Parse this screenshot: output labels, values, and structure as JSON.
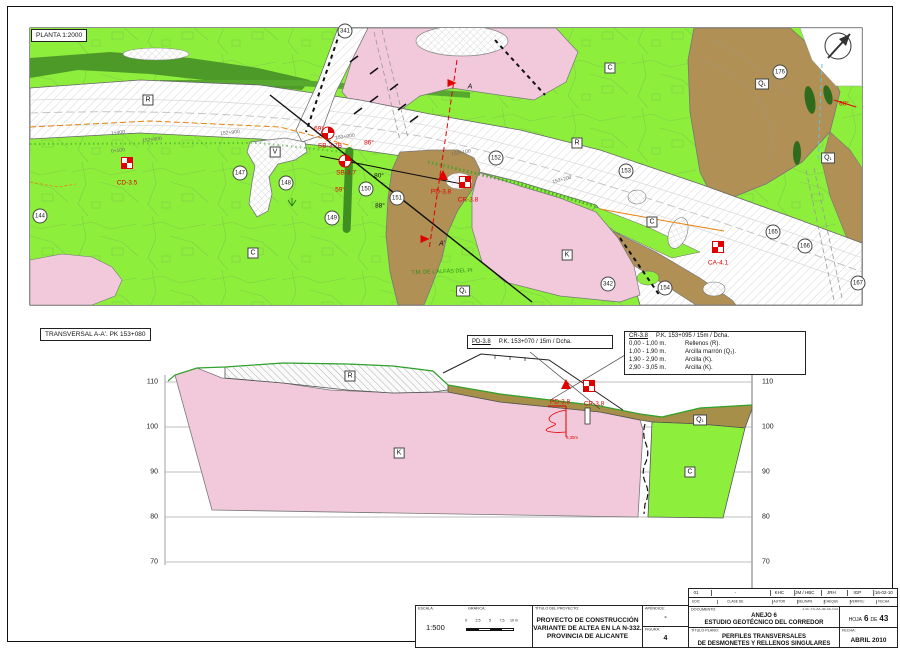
{
  "sheet": {
    "plan_title": "PLANTA 1:2000",
    "section_title": "TRANSVERSAL A-A'. PK 153+080"
  },
  "plan": {
    "unit_labels": [
      {
        "t": "R",
        "x": 148,
        "y": 100
      },
      {
        "t": "R",
        "x": 577,
        "y": 143
      },
      {
        "t": "V",
        "x": 275,
        "y": 152
      },
      {
        "t": "C",
        "x": 253,
        "y": 253
      },
      {
        "t": "C",
        "x": 610,
        "y": 68
      },
      {
        "t": "C",
        "x": 652,
        "y": 222
      },
      {
        "t": "K",
        "x": 567,
        "y": 255
      },
      {
        "t": "Q₁",
        "x": 762,
        "y": 84
      },
      {
        "t": "Q₁",
        "x": 828,
        "y": 158
      },
      {
        "t": "Q₁",
        "x": 463,
        "y": 291
      }
    ],
    "point_circles": [
      {
        "n": "144",
        "x": 40,
        "y": 216
      },
      {
        "n": "147",
        "x": 240,
        "y": 173
      },
      {
        "n": "148",
        "x": 286,
        "y": 183
      },
      {
        "n": "149",
        "x": 332,
        "y": 218
      },
      {
        "n": "150",
        "x": 366,
        "y": 189
      },
      {
        "n": "151",
        "x": 397,
        "y": 198
      },
      {
        "n": "152",
        "x": 496,
        "y": 158
      },
      {
        "n": "153",
        "x": 626,
        "y": 171
      },
      {
        "n": "154",
        "x": 665,
        "y": 288
      },
      {
        "n": "165",
        "x": 773,
        "y": 232
      },
      {
        "n": "166",
        "x": 805,
        "y": 246
      },
      {
        "n": "167",
        "x": 858,
        "y": 283
      },
      {
        "n": "176",
        "x": 780,
        "y": 72
      },
      {
        "n": "341",
        "x": 345,
        "y": 31
      },
      {
        "n": "342",
        "x": 608,
        "y": 284
      }
    ],
    "red_markers": [
      {
        "id": "CD-3.5",
        "type": "square",
        "x": 127,
        "y": 163,
        "lx": 127,
        "ly": 183
      },
      {
        "id": "SB-3.7B",
        "type": "circle",
        "x": 328,
        "y": 133,
        "lx": 330,
        "ly": 146
      },
      {
        "id": "SB-3.7",
        "type": "circle",
        "x": 345,
        "y": 161,
        "lx": 346,
        "ly": 173
      },
      {
        "id": "PD-3.8",
        "type": "triangle",
        "x": 443,
        "y": 175,
        "lx": 441,
        "ly": 192
      },
      {
        "id": "CR-3.8",
        "type": "square",
        "x": 465,
        "y": 182,
        "lx": 468,
        "ly": 200
      },
      {
        "id": "CA-4.1",
        "type": "square",
        "x": 718,
        "y": 247,
        "lx": 718,
        "ly": 263
      }
    ],
    "dip_labels": [
      {
        "t": "69°",
        "x": 319,
        "y": 129,
        "c": "red"
      },
      {
        "t": "86°",
        "x": 369,
        "y": 143,
        "c": "red"
      },
      {
        "t": "59°",
        "x": 340,
        "y": 190,
        "c": "red"
      },
      {
        "t": "60°",
        "x": 844,
        "y": 104,
        "c": "red"
      },
      {
        "t": "80°",
        "x": 379,
        "y": 176,
        "c": "black"
      },
      {
        "t": "88°",
        "x": 380,
        "y": 206,
        "c": "black"
      }
    ],
    "station_labels": [
      {
        "t": "1+400",
        "x": 118,
        "y": 133,
        "r": -6
      },
      {
        "t": "0+100",
        "x": 118,
        "y": 151,
        "r": -6
      },
      {
        "t": "152+800",
        "x": 152,
        "y": 140,
        "r": -6
      },
      {
        "t": "152+900",
        "x": 230,
        "y": 133,
        "r": -6
      },
      {
        "t": "153+000",
        "x": 345,
        "y": 137,
        "r": -8
      },
      {
        "t": "153+100",
        "x": 461,
        "y": 153,
        "r": -10
      },
      {
        "t": "153+200",
        "x": 562,
        "y": 180,
        "r": -14
      }
    ],
    "section_arrows": [
      {
        "t": "A",
        "x": 452,
        "y": 83,
        "lx": 470,
        "ly": 87
      },
      {
        "t": "A'",
        "x": 425,
        "y": 239,
        "lx": 442,
        "ly": 244
      }
    ],
    "boundary_label": {
      "t": "T.M. DE L'ALFÀS DEL PI",
      "x": 442,
      "y": 272
    }
  },
  "section": {
    "elevations": [
      "110",
      "100",
      "90",
      "80",
      "70"
    ],
    "unit_labels": [
      {
        "t": "R",
        "x": 350,
        "y": 376
      },
      {
        "t": "K",
        "x": 399,
        "y": 453
      },
      {
        "t": "Q₁",
        "x": 700,
        "y": 420
      },
      {
        "t": "C",
        "x": 690,
        "y": 472
      }
    ],
    "markers": [
      {
        "id": "PD-3.8",
        "type": "triangle",
        "x": 566,
        "y": 384,
        "lx": 560,
        "ly": 402
      },
      {
        "id": "CR-3.8",
        "type": "square",
        "x": 589,
        "y": 386,
        "lx": 594,
        "ly": 404
      }
    ],
    "log_depth_label": "6,30m",
    "legend_pd": {
      "id": "PD-3.8",
      "loc": "P.K. 153+070 / 15m / Dcha."
    },
    "legend_cr": {
      "id": "CR-3.8",
      "loc": "P.K. 153+095 / 15m / Dcha.",
      "rows": [
        [
          "0,00 - 1,00 m.",
          "Rellenos (R)."
        ],
        [
          "1,00 - 1,90 m.",
          "Arcilla marrón (Q₁)."
        ],
        [
          "1,90 - 2,90 m.",
          "Arcilla (K)."
        ],
        [
          "2,90 - 3,05 m.",
          "Arcilla (K)."
        ]
      ]
    }
  },
  "titleblock": {
    "escala_label": "ESCALA:",
    "escala": "1:500",
    "grafica_label": "GRÁFICA:",
    "bar_ticks": [
      "0",
      "2,5",
      "5",
      "7,5",
      "10 m"
    ],
    "proyecto_label": "TÍTULO DEL PROYECTO:",
    "proyecto_lines": [
      "PROYECTO DE CONSTRUCCIÓN",
      "VARIANTE DE ALTEA EN LA N-332.",
      "PROVINCIA DE ALICANTE"
    ],
    "apendice_label": "APÉNDICE:",
    "apendice": "-",
    "figura_label": "FIGURA:",
    "figura": "4",
    "rev_values": [
      "01",
      "-",
      "KHC",
      "JM / HBC",
      "JRH",
      "IGP",
      "16-02-10"
    ],
    "rev_headers": [
      "EDICIÓN",
      "CLASE DE MODIFICACIÓN",
      "AUTOR",
      "DELIN/REV",
      "CHEQUEADO",
      "VERIFICADO",
      "FECHA"
    ],
    "documento_label": "DOCUMENTO:",
    "documento_lines": [
      "ANEJO 6",
      "ESTUDIO GEOTÉCNICO DEL CORREDOR"
    ],
    "codigo": "3787-FD-AX-06-SE-G41",
    "hoja_label": "HOJA",
    "hoja_num": "6",
    "de_label": "DE",
    "hoja_total": "43",
    "plano_label": "TÍTULO PLANO:",
    "plano_lines": [
      "PERFILES TRANSVERSALES",
      "DE DESMONETES Y RELLENOS SINGULARES"
    ],
    "fecha_label": "FECHA:",
    "fecha": "ABRIL 2010"
  },
  "colors": {
    "map_green": "#8def3c",
    "dark_green": "#4e9a28",
    "pink": "#f2c9da",
    "brown": "#b09055",
    "section_brown": "#a68f48",
    "red": "#e10000",
    "orange": "#e8820c"
  }
}
